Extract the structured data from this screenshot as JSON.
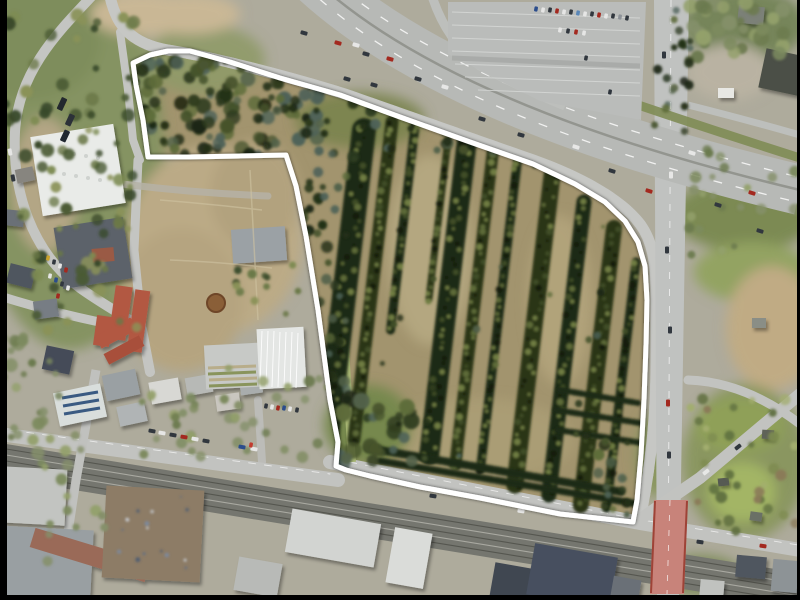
{
  "meta": {
    "width": 800,
    "height": 600,
    "kind": "aerial-photograph-with-site-boundary"
  },
  "colors": {
    "boundary": "#ffffff",
    "ground": "#aeab9c",
    "parcel_dirt": "#a2946e",
    "road": "#c4c5c2",
    "highway": "#b7b9b6",
    "rail": "#75766f",
    "tree_dark": "#232e16",
    "grass": "#7f8c55",
    "bridge_pink": "#c8837a",
    "border_black": "#000000"
  },
  "site_outline": {
    "stroke": "#ffffff",
    "stroke_width": 5,
    "points": [
      [
        133,
        63
      ],
      [
        150,
        55
      ],
      [
        168,
        51
      ],
      [
        190,
        51
      ],
      [
        230,
        62
      ],
      [
        280,
        78
      ],
      [
        340,
        95
      ],
      [
        400,
        117
      ],
      [
        470,
        142
      ],
      [
        533,
        164
      ],
      [
        575,
        184
      ],
      [
        605,
        202
      ],
      [
        625,
        221
      ],
      [
        638,
        242
      ],
      [
        645,
        266
      ],
      [
        647,
        300
      ],
      [
        646,
        345
      ],
      [
        644,
        400
      ],
      [
        641,
        455
      ],
      [
        637,
        500
      ],
      [
        633,
        522
      ],
      [
        560,
        514
      ],
      [
        480,
        498
      ],
      [
        420,
        487
      ],
      [
        370,
        476
      ],
      [
        346,
        470
      ],
      [
        336,
        466
      ],
      [
        338,
        442
      ],
      [
        330,
        400
      ],
      [
        318,
        310
      ],
      [
        306,
        236
      ],
      [
        296,
        186
      ],
      [
        286,
        155
      ],
      [
        240,
        156
      ],
      [
        190,
        157
      ],
      [
        148,
        157
      ],
      [
        143,
        120
      ],
      [
        136,
        85
      ]
    ]
  },
  "terrain": [
    [
      70,
      160,
      95,
      190,
      "#859362",
      1
    ],
    [
      30,
      40,
      70,
      60,
      "#7e8d5c",
      1
    ],
    [
      45,
      185,
      34,
      68,
      "#b3a685",
      1
    ],
    [
      215,
      240,
      88,
      95,
      "#bbaa86",
      1
    ],
    [
      182,
      300,
      62,
      72,
      "#b5a480",
      1
    ],
    [
      255,
      195,
      45,
      55,
      "#b2a27e",
      1
    ],
    [
      430,
      250,
      42,
      95,
      "#b6a982",
      0.9
    ],
    [
      560,
      300,
      32,
      85,
      "#b2a47c",
      0.9
    ],
    [
      480,
      440,
      95,
      42,
      "#ab9d76",
      0.9
    ],
    [
      368,
      425,
      44,
      40,
      "#76884e",
      1
    ],
    [
      745,
      215,
      72,
      36,
      "#7c8a52",
      1
    ],
    [
      752,
      272,
      58,
      30,
      "#93a362",
      1
    ],
    [
      772,
      328,
      46,
      62,
      "#c0ab84",
      1
    ],
    [
      745,
      462,
      62,
      78,
      "#8a9660",
      1
    ],
    [
      742,
      492,
      34,
      30,
      "#a3b565",
      1
    ],
    [
      740,
      426,
      44,
      28,
      "#8fa058",
      1
    ],
    [
      745,
      25,
      62,
      36,
      "#76855a",
      1
    ],
    [
      730,
      72,
      42,
      28,
      "#b9b2a2",
      1
    ],
    [
      700,
      575,
      42,
      20,
      "#7d8b58",
      1
    ],
    [
      655,
      455,
      20,
      42,
      "#8a9660",
      1
    ],
    [
      360,
      120,
      65,
      28,
      "#79834c",
      0.9
    ],
    [
      205,
      60,
      60,
      35,
      "#8f9a68",
      0.9
    ],
    [
      142,
      14,
      52,
      22,
      "#c9b795",
      1
    ],
    [
      190,
      14,
      50,
      20,
      "#c9b795",
      1
    ]
  ],
  "palettes": {
    "forest": [
      "#1c2613",
      "#2e3b1e",
      "#46532c",
      "#5d6b3a",
      "#233018",
      "#4e6258",
      "#53624a"
    ],
    "mixed": [
      "#4a5a33",
      "#6a7847",
      "#8a9258",
      "#3a4a2a",
      "#7d8b52"
    ],
    "muted": [
      "#7c8a5e",
      "#93a06b",
      "#6b7a4e",
      "#85906a"
    ],
    "garden": [
      "#5f6f3f",
      "#7e8c50",
      "#a2ad6e",
      "#8a7a58"
    ],
    "debris": [
      "#5c6e86",
      "#c9cfd6",
      "#7b8aa0",
      "#4a5a72"
    ]
  },
  "scatter_outside": [
    {
      "x": 688,
      "y": 2,
      "w": 112,
      "h": 55,
      "n": 30,
      "r1": 4,
      "r2": 8,
      "p": "muted",
      "seed": 11
    },
    {
      "x": 688,
      "y": 148,
      "w": 112,
      "h": 115,
      "n": 22,
      "r1": 3,
      "r2": 6,
      "p": "muted",
      "seed": 12
    },
    {
      "x": 690,
      "y": 395,
      "w": 108,
      "h": 138,
      "n": 35,
      "r1": 3,
      "r2": 6,
      "p": "garden",
      "seed": 13
    },
    {
      "x": 2,
      "y": 15,
      "w": 135,
      "h": 318,
      "n": 85,
      "r1": 3,
      "r2": 7,
      "p": "mixed",
      "seed": 14
    },
    {
      "x": 2,
      "y": 330,
      "w": 60,
      "h": 142,
      "n": 26,
      "r1": 3,
      "r2": 7,
      "p": "muted",
      "seed": 15
    },
    {
      "x": 140,
      "y": 368,
      "w": 195,
      "h": 92,
      "n": 28,
      "r1": 3,
      "r2": 6,
      "p": "muted",
      "seed": 16
    },
    {
      "x": 652,
      "y": 4,
      "w": 40,
      "h": 138,
      "n": 22,
      "r1": 3,
      "r2": 5,
      "p": "forest",
      "seed": 17
    },
    {
      "x": 42,
      "y": 420,
      "w": 64,
      "h": 150,
      "n": 14,
      "r1": 3,
      "r2": 6,
      "p": "muted",
      "seed": 18
    },
    {
      "x": 232,
      "y": 265,
      "w": 70,
      "h": 55,
      "n": 12,
      "r1": 3,
      "r2": 5,
      "p": "mixed",
      "seed": 19
    },
    {
      "x": 175,
      "y": 395,
      "w": 80,
      "h": 58,
      "n": 12,
      "r1": 3,
      "r2": 6,
      "p": "muted",
      "seed": 20
    },
    {
      "x": 112,
      "y": 494,
      "w": 82,
      "h": 76,
      "n": 16,
      "r1": 1,
      "r2": 2.5,
      "p": "debris",
      "seed": 21
    }
  ],
  "scatter_parcel": [
    {
      "x": 142,
      "y": 60,
      "w": 178,
      "h": 95,
      "n": 120,
      "r1": 3,
      "r2": 8,
      "p": "forest",
      "seed": 31
    },
    {
      "x": 294,
      "y": 148,
      "w": 54,
      "h": 318,
      "n": 70,
      "r1": 3,
      "r2": 6,
      "p": "forest",
      "seed": 32
    },
    {
      "x": 305,
      "y": 98,
      "w": 255,
      "h": 62,
      "n": 40,
      "r1": 3,
      "r2": 6,
      "p": "forest",
      "seed": 33
    },
    {
      "x": 330,
      "y": 390,
      "w": 84,
      "h": 76,
      "n": 26,
      "r1": 4,
      "r2": 9,
      "p": "forest",
      "seed": 34
    },
    {
      "x": 598,
      "y": 430,
      "w": 46,
      "h": 85,
      "n": 14,
      "r1": 3,
      "r2": 6,
      "p": "forest",
      "seed": 35
    },
    {
      "x": 350,
      "y": 160,
      "w": 290,
      "h": 300,
      "n": 22,
      "r1": 2,
      "r2": 4,
      "p": "forest",
      "seed": 36
    }
  ],
  "nursery_rows": [
    [
      364,
      130,
      435,
      24
    ],
    [
      392,
      122,
      440,
      13
    ],
    [
      416,
      118,
      330,
      9
    ],
    [
      448,
      140,
      300,
      7
    ],
    [
      468,
      132,
      455,
      20
    ],
    [
      494,
      142,
      465,
      12
    ],
    [
      518,
      156,
      470,
      9
    ],
    [
      552,
      176,
      485,
      17
    ],
    [
      584,
      202,
      495,
      15
    ],
    [
      614,
      228,
      505,
      16
    ],
    [
      636,
      262,
      508,
      9
    ]
  ],
  "hedge_rows": [
    [
      368,
      448,
      622,
      492,
      8
    ],
    [
      380,
      461,
      638,
      504,
      7
    ],
    [
      560,
      390,
      638,
      403,
      6
    ],
    [
      556,
      410,
      640,
      423,
      6
    ],
    [
      558,
      430,
      642,
      443,
      6
    ]
  ],
  "buildings": [
    [
      36,
      130,
      84,
      80,
      -9,
      "#e9ebe8"
    ],
    [
      58,
      222,
      70,
      62,
      -9,
      "#5b626b"
    ],
    [
      92,
      248,
      22,
      14,
      -5,
      "#9a5a45"
    ],
    [
      112,
      286,
      17,
      54,
      8,
      "#b25843"
    ],
    [
      131,
      290,
      15,
      62,
      8,
      "#b25843"
    ],
    [
      95,
      316,
      16,
      30,
      8,
      "#b25843"
    ],
    [
      8,
      266,
      26,
      20,
      14,
      "#4f565e"
    ],
    [
      34,
      300,
      24,
      18,
      -8,
      "#777d84"
    ],
    [
      2,
      210,
      22,
      16,
      6,
      "#6a7077"
    ],
    [
      44,
      348,
      28,
      24,
      12,
      "#454c58"
    ],
    [
      96,
      326,
      40,
      14,
      -28,
      "#b25843"
    ],
    [
      104,
      344,
      40,
      12,
      -28,
      "#a84f3b"
    ],
    [
      56,
      388,
      48,
      34,
      -12,
      "#d9dedc"
    ],
    [
      104,
      372,
      34,
      26,
      -12,
      "#9aa0a3"
    ],
    [
      118,
      404,
      28,
      20,
      -12,
      "#b0b4b5"
    ],
    [
      150,
      380,
      30,
      22,
      -10,
      "#d8d8d4"
    ],
    [
      186,
      376,
      26,
      18,
      -10,
      "#b7b9b6"
    ],
    [
      216,
      394,
      24,
      16,
      -8,
      "#c9c6bf"
    ],
    [
      240,
      378,
      22,
      16,
      -8,
      "#a9adad"
    ],
    [
      232,
      228,
      54,
      34,
      -4,
      "#9ba1a5"
    ],
    [
      205,
      344,
      58,
      44,
      -3,
      "#c7c9c6"
    ],
    [
      258,
      328,
      47,
      60,
      -3,
      "#e4e6e4"
    ],
    [
      762,
      52,
      40,
      40,
      12,
      "#4b5046"
    ],
    [
      718,
      88,
      16,
      10,
      0,
      "#e8e8e4"
    ],
    [
      738,
      6,
      26,
      18,
      6,
      "#7b8178"
    ],
    [
      16,
      168,
      18,
      14,
      -12,
      "#87857f"
    ],
    [
      0,
      468,
      66,
      56,
      3,
      "#c2c4c1"
    ],
    [
      0,
      528,
      92,
      70,
      3,
      "#999fa2"
    ],
    [
      30,
      545,
      120,
      20,
      17,
      "#9a6a59"
    ],
    [
      104,
      488,
      98,
      92,
      3,
      "#8d7c66"
    ],
    [
      288,
      516,
      90,
      44,
      10,
      "#d2d4d1"
    ],
    [
      390,
      530,
      38,
      56,
      10,
      "#dadcd9"
    ],
    [
      492,
      566,
      46,
      36,
      10,
      "#3f4651"
    ],
    [
      530,
      550,
      84,
      52,
      10,
      "#47505e"
    ],
    [
      612,
      578,
      28,
      20,
      10,
      "#6a7077"
    ],
    [
      236,
      560,
      44,
      34,
      10,
      "#b8bab7"
    ],
    [
      736,
      556,
      30,
      22,
      5,
      "#4f565e"
    ],
    [
      772,
      560,
      26,
      32,
      5,
      "#8d9396"
    ],
    [
      700,
      580,
      24,
      16,
      5,
      "#c0c2bf"
    ],
    [
      750,
      512,
      12,
      9,
      8,
      "#6b6f66"
    ],
    [
      718,
      478,
      11,
      8,
      -6,
      "#565a52"
    ],
    [
      762,
      430,
      12,
      9,
      4,
      "#5e6258"
    ],
    [
      752,
      318,
      14,
      10,
      0,
      "#8a8e86"
    ]
  ],
  "vehicles": [
    [
      304,
      33,
      15
    ],
    [
      338,
      43,
      15,
      "#a3291f"
    ],
    [
      356,
      45,
      15,
      "#e7e7e6"
    ],
    [
      366,
      54,
      15
    ],
    [
      390,
      59,
      15,
      "#a3291f"
    ],
    [
      347,
      79,
      16
    ],
    [
      374,
      85,
      16
    ],
    [
      418,
      79,
      16
    ],
    [
      445,
      87,
      16,
      "#e7e7e6"
    ],
    [
      482,
      119,
      16
    ],
    [
      521,
      135,
      16
    ],
    [
      576,
      147,
      17,
      "#e7e7e6"
    ],
    [
      612,
      171,
      17
    ],
    [
      649,
      191,
      17,
      "#a3291f"
    ],
    [
      692,
      153,
      17,
      "#e7e7e6"
    ],
    [
      718,
      205,
      17
    ],
    [
      752,
      193,
      17,
      "#a3291f"
    ],
    [
      760,
      231,
      17
    ],
    [
      664,
      55,
      90
    ],
    [
      671,
      175,
      90,
      "#e7e7e6"
    ],
    [
      667,
      250,
      90
    ],
    [
      670,
      330,
      90
    ],
    [
      668,
      403,
      90,
      "#a3291f"
    ],
    [
      669,
      455,
      90
    ],
    [
      433,
      496,
      9
    ],
    [
      521,
      511,
      9,
      "#e7e7e6"
    ],
    [
      700,
      542,
      8
    ],
    [
      763,
      546,
      8,
      "#a3291f"
    ],
    [
      706,
      472,
      -38,
      "#e7e7e6"
    ],
    [
      738,
      447,
      -38
    ],
    [
      536,
      9,
      100,
      "#2b4d8c",
      5,
      3.5
    ],
    [
      543,
      10,
      100,
      "#e6e6e5",
      5,
      3.5
    ],
    [
      550,
      10,
      100,
      "#31373e",
      5,
      3.5
    ],
    [
      557,
      11,
      100,
      "#a3291f",
      5,
      3.5
    ],
    [
      564,
      12,
      100,
      "#e6e6e5",
      5,
      3.5
    ],
    [
      571,
      12,
      100,
      "#31373e",
      5,
      3.5
    ],
    [
      578,
      13,
      100,
      "#5a87b8",
      5,
      3.5
    ],
    [
      585,
      14,
      100,
      "#e6e6e5",
      5,
      3.5
    ],
    [
      592,
      14,
      100,
      "#31373e",
      5,
      3.5
    ],
    [
      599,
      15,
      100,
      "#a3291f",
      5,
      3.5
    ],
    [
      606,
      16,
      100,
      "#e6e6e5",
      5,
      3.5
    ],
    [
      613,
      16,
      100,
      "#31373e",
      5,
      3.5
    ],
    [
      620,
      17,
      100,
      "#8d9298",
      5,
      3.5
    ],
    [
      627,
      18,
      100,
      "#31373e",
      5,
      3.5
    ],
    [
      560,
      30,
      100,
      "#e6e6e5",
      5,
      3.5
    ],
    [
      568,
      31,
      100,
      "#31373e",
      5,
      3.5
    ],
    [
      576,
      32,
      100,
      "#a3291f",
      5,
      3.5
    ],
    [
      584,
      33,
      100,
      "#e6e6e5",
      5,
      3.5
    ],
    [
      586,
      58,
      100,
      "#31373e",
      5,
      3.5
    ],
    [
      610,
      92,
      100,
      "#2e343c",
      5,
      3.5
    ],
    [
      48,
      258,
      100,
      "#c9a22b",
      5,
      3.5
    ],
    [
      54,
      262,
      100,
      "#31373e",
      5,
      3.5
    ],
    [
      60,
      266,
      100,
      "#e6e6e5",
      5,
      3.5
    ],
    [
      66,
      270,
      100,
      "#a3291f",
      5,
      3.5
    ],
    [
      50,
      276,
      100,
      "#e6e6e5",
      5,
      3.5
    ],
    [
      56,
      280,
      100,
      "#2b4d8c",
      5,
      3.5
    ],
    [
      62,
      284,
      100,
      "#31373e",
      5,
      3.5
    ],
    [
      68,
      288,
      100,
      "#e6e6e5",
      5,
      3.5
    ],
    [
      58,
      296,
      100,
      "#a3291f",
      5,
      3.5
    ],
    [
      152,
      431,
      10
    ],
    [
      162,
      433,
      10,
      "#e6e6e5"
    ],
    [
      173,
      435,
      10
    ],
    [
      184,
      437,
      10,
      "#a3291f"
    ],
    [
      195,
      439,
      10,
      "#e6e6e5"
    ],
    [
      206,
      441,
      10
    ],
    [
      242,
      447,
      10,
      "#2b4d8c"
    ],
    [
      254,
      449,
      10,
      "#e6e6e5"
    ],
    [
      266,
      406,
      100,
      "#31373e",
      5,
      3.5
    ],
    [
      272,
      407,
      100,
      "#e6e6e5",
      5,
      3.5
    ],
    [
      278,
      408,
      100,
      "#a3291f",
      5,
      3.5
    ],
    [
      284,
      408,
      100,
      "#2b4d8c",
      5,
      3.5
    ],
    [
      290,
      409,
      100,
      "#e6e6e5",
      5,
      3.5
    ],
    [
      297,
      410,
      100,
      "#31373e",
      5,
      3.5
    ],
    [
      251,
      445,
      100,
      "#c23b2e",
      5,
      3.5
    ],
    [
      62,
      104,
      -65,
      "#23282e",
      13,
      6
    ],
    [
      70,
      120,
      -65,
      "#2c3138",
      12,
      6
    ],
    [
      65,
      136,
      -65,
      "#202730",
      12,
      6
    ],
    [
      10,
      152,
      80,
      "#e6e6e5"
    ],
    [
      13,
      178,
      80,
      "#31373e"
    ]
  ],
  "borders": {
    "left_px": 7,
    "right_px": 3,
    "bottom_px": 5
  }
}
